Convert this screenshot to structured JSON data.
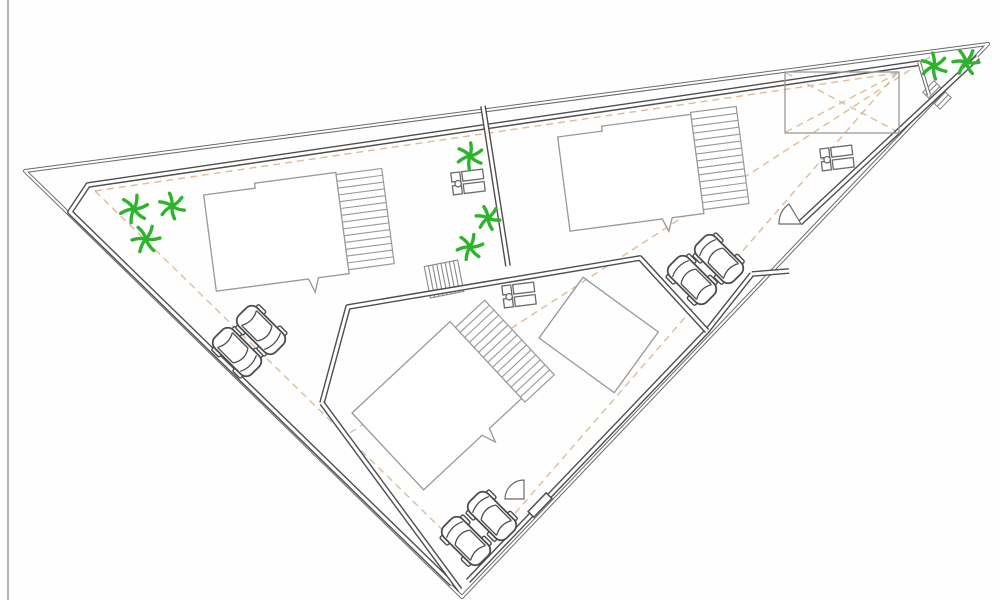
{
  "meta": {
    "type": "architectural-site-plan",
    "canvas": {
      "w": 1000,
      "h": 600,
      "background": "#fefefe"
    }
  },
  "palette": {
    "boundary": "#6a6a6a",
    "parcel": "#4e4e4e",
    "building": "#98989a",
    "car": "#4c4c4c",
    "tree": "#2cb52c",
    "setback": "#dcb893",
    "stairs": "#8a8a8a",
    "equipment": "#6a6a6a",
    "frame": "#9a9a9a",
    "white": "#ffffff"
  },
  "setback_lines": [
    {
      "name": "setback-line-top",
      "points": [
        [
          95,
          191
        ],
        [
          897,
          73
        ]
      ]
    },
    {
      "name": "setback-line-left",
      "points": [
        [
          95,
          191
        ],
        [
          462,
          549
        ]
      ]
    },
    {
      "name": "setback-line-right",
      "points": [
        [
          897,
          73
        ],
        [
          478,
          556
        ]
      ]
    },
    {
      "name": "sight-line-diagonal",
      "points": [
        [
          930,
          57
        ],
        [
          345,
          436
        ]
      ]
    },
    {
      "name": "annex-diagonal-1",
      "points": [
        [
          786,
          132
        ],
        [
          898,
          73
        ]
      ]
    },
    {
      "name": "annex-diagonal-2",
      "points": [
        [
          786,
          73
        ],
        [
          898,
          132
        ]
      ]
    }
  ],
  "boundaries": [
    {
      "name": "outer-site-boundary",
      "weight": "light",
      "closed": true,
      "points": [
        [
          25,
          171
        ],
        [
          988,
          44
        ],
        [
          462,
          597
        ]
      ]
    },
    {
      "name": "inner-boundary-top-left",
      "weight": "heavy",
      "closed": false,
      "points": [
        [
          920,
          63
        ],
        [
          88,
          185
        ],
        [
          70,
          212
        ],
        [
          452,
          584
        ]
      ]
    },
    {
      "name": "inner-boundary-right-upper",
      "weight": "heavy",
      "closed": false,
      "points": [
        [
          978,
          57
        ],
        [
          800,
          223
        ]
      ]
    },
    {
      "name": "inner-boundary-right-lower",
      "weight": "heavy",
      "closed": false,
      "points": [
        [
          752,
          274
        ],
        [
          707,
          331
        ],
        [
          468,
          581
        ]
      ]
    },
    {
      "name": "gate-connector-wall",
      "weight": "heavy",
      "closed": false,
      "points": [
        [
          752,
          274
        ],
        [
          789,
          271
        ]
      ]
    },
    {
      "name": "parcel-partition-wall",
      "weight": "heavy",
      "closed": false,
      "points": [
        [
          483,
          106
        ],
        [
          508,
          266
        ]
      ]
    },
    {
      "name": "apex-corner-partition",
      "weight": "light",
      "closed": false,
      "points": [
        [
          919,
          62
        ],
        [
          929,
          95
        ]
      ]
    },
    {
      "name": "parcel3-north-wall",
      "weight": "heavy",
      "closed": false,
      "points": [
        [
          322,
          403
        ],
        [
          348,
          307
        ],
        [
          640,
          258
        ],
        [
          707,
          331
        ]
      ]
    },
    {
      "name": "parcel3-west-wall",
      "weight": "heavy",
      "closed": false,
      "points": [
        [
          322,
          403
        ],
        [
          460,
          590
        ]
      ]
    }
  ],
  "buildings": [
    {
      "name": "building-1",
      "x": 203,
      "y": 190,
      "rotation": -7.5,
      "body": [
        [
          0,
          5
        ],
        [
          52,
          5
        ],
        [
          52,
          0
        ],
        [
          134,
          0
        ],
        [
          134,
          102
        ],
        [
          103,
          102
        ],
        [
          98,
          116
        ],
        [
          93,
          102
        ],
        [
          0,
          102
        ]
      ],
      "band": {
        "x": 134,
        "y": 2,
        "w": 46,
        "h": 96,
        "lines": 14
      }
    },
    {
      "name": "building-2",
      "x": 557,
      "y": 132,
      "rotation": -7.5,
      "body": [
        [
          0,
          5
        ],
        [
          45,
          5
        ],
        [
          45,
          0
        ],
        [
          135,
          0
        ],
        [
          135,
          100
        ],
        [
          103,
          100
        ],
        [
          98,
          113
        ],
        [
          93,
          100
        ],
        [
          0,
          100
        ]
      ],
      "band": {
        "x": 135,
        "y": -2,
        "w": 46,
        "h": 98,
        "lines": 14
      }
    },
    {
      "name": "building-3",
      "x": 352,
      "y": 413,
      "rotation": -43,
      "body": [
        [
          0,
          0
        ],
        [
          134,
          0
        ],
        [
          134,
          105
        ],
        [
          90,
          105
        ],
        [
          85,
          119
        ],
        [
          80,
          105
        ],
        [
          0,
          105
        ]
      ],
      "band": {
        "x": 134,
        "y": 8,
        "w": 40,
        "h": 102,
        "lines": 15
      }
    }
  ],
  "annexes": [
    {
      "name": "annex-north",
      "x": 785,
      "y": 72,
      "rotation": 0,
      "ox": 0,
      "oy": 0,
      "w": 114,
      "h": 61
    },
    {
      "name": "annex-south",
      "x": 539,
      "y": 338,
      "rotation": 36,
      "ox": 0,
      "oy": -75,
      "w": 93,
      "h": 75
    }
  ],
  "stairs": [
    {
      "name": "stairs-parcel3",
      "x": 444,
      "y": 279,
      "rotation": -11,
      "w": 34,
      "h": 32,
      "steps": 8
    },
    {
      "name": "stairs-apex-corner",
      "x": 937,
      "y": 95,
      "rotation": 44,
      "w": 24,
      "h": 16,
      "steps": 6
    }
  ],
  "equipment": [
    {
      "name": "equipment-parcel1",
      "x": 468,
      "y": 182,
      "rotation": -7
    },
    {
      "name": "equipment-parcel2",
      "x": 837,
      "y": 158,
      "rotation": -7
    },
    {
      "name": "equipment-parcel3",
      "x": 519,
      "y": 295,
      "rotation": -7
    }
  ],
  "cars": [
    {
      "name": "car-1",
      "x": 237,
      "y": 352,
      "rotation": 135
    },
    {
      "name": "car-2",
      "x": 261,
      "y": 330,
      "rotation": 135
    },
    {
      "name": "car-3",
      "x": 692,
      "y": 280,
      "rotation": -45
    },
    {
      "name": "car-4",
      "x": 719,
      "y": 259,
      "rotation": -45
    },
    {
      "name": "car-5",
      "x": 466,
      "y": 541,
      "rotation": -45
    },
    {
      "name": "car-6",
      "x": 492,
      "y": 516,
      "rotation": -45
    }
  ],
  "trees": [
    {
      "name": "tree-1",
      "x": 134,
      "y": 209,
      "r": 14
    },
    {
      "name": "tree-2",
      "x": 172,
      "y": 206,
      "r": 13
    },
    {
      "name": "tree-3",
      "x": 146,
      "y": 239,
      "r": 14
    },
    {
      "name": "tree-4",
      "x": 470,
      "y": 156,
      "r": 13
    },
    {
      "name": "tree-5",
      "x": 488,
      "y": 218,
      "r": 12
    },
    {
      "name": "tree-6",
      "x": 470,
      "y": 247,
      "r": 13
    },
    {
      "name": "tree-7",
      "x": 934,
      "y": 66,
      "r": 13
    },
    {
      "name": "tree-8",
      "x": 966,
      "y": 62,
      "r": 13
    }
  ],
  "gates": [
    {
      "name": "gate-swing-north",
      "type": "swing",
      "path": "M801,224 L789,204 A23,23 0 0 0 779,224 Z"
    },
    {
      "name": "gate-swing-south",
      "type": "swing",
      "path": "M524,480 A19,19 0 0 0 505,499 L524,499 Z"
    },
    {
      "name": "gate-door-south",
      "type": "door",
      "x": 540,
      "y": 505,
      "rotation": -46,
      "w": 26,
      "h": 8
    }
  ],
  "frame": {
    "name": "image-left-border",
    "points": [
      [
        8,
        0
      ],
      [
        8,
        600
      ]
    ]
  }
}
